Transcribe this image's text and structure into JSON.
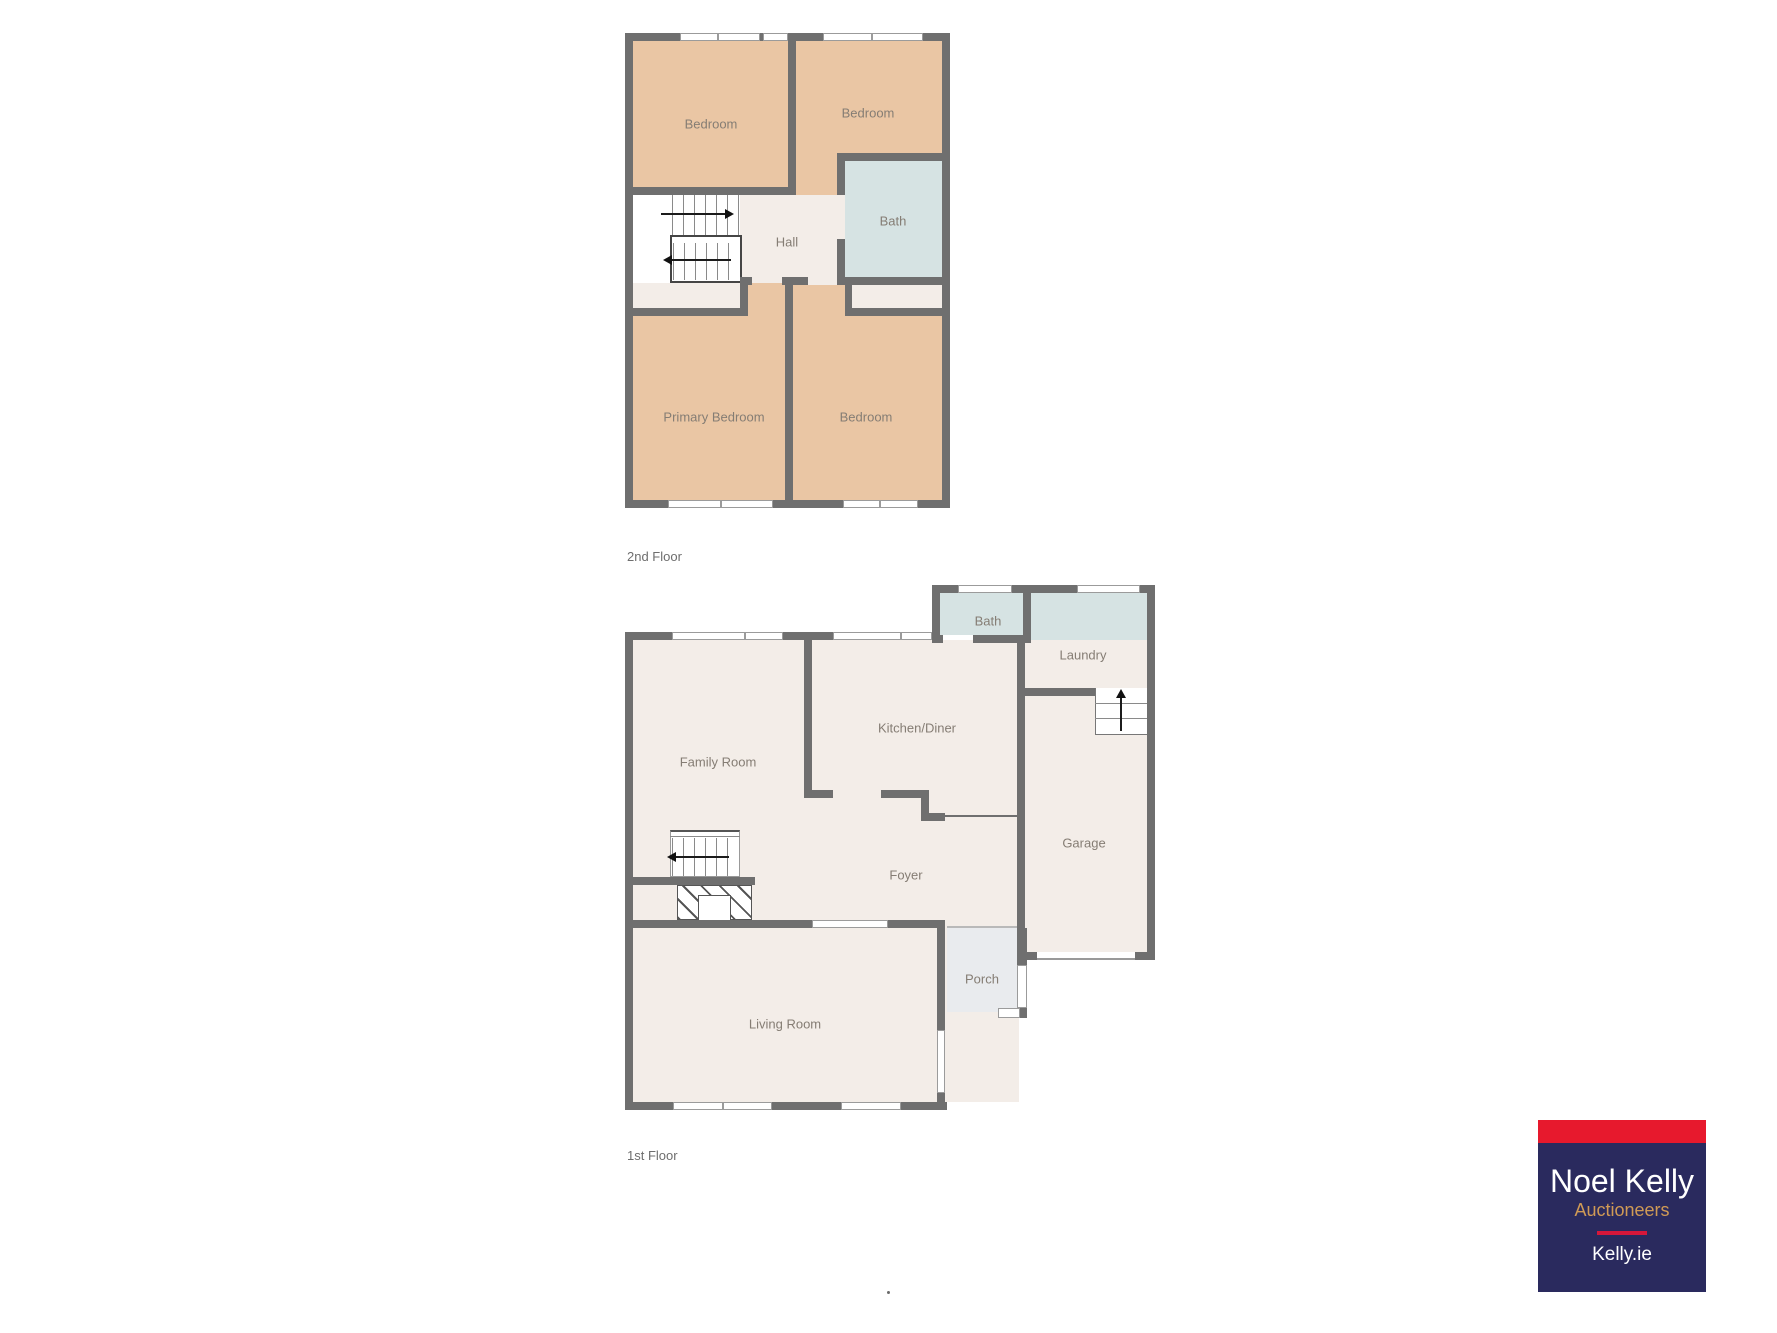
{
  "floors": [
    {
      "caption": "2nd Floor",
      "rooms": [
        {
          "name": "bedroom-top-left",
          "label": "Bedroom"
        },
        {
          "name": "bedroom-top-right",
          "label": "Bedroom"
        },
        {
          "name": "bath",
          "label": "Bath"
        },
        {
          "name": "hall",
          "label": "Hall"
        },
        {
          "name": "primary-bedroom",
          "label": "Primary Bedroom"
        },
        {
          "name": "bedroom-bottom",
          "label": "Bedroom"
        }
      ]
    },
    {
      "caption": "1st Floor",
      "rooms": [
        {
          "name": "bath",
          "label": "Bath"
        },
        {
          "name": "laundry",
          "label": "Laundry"
        },
        {
          "name": "kitchen-diner",
          "label": "Kitchen/Diner"
        },
        {
          "name": "family-room",
          "label": "Family Room"
        },
        {
          "name": "foyer",
          "label": "Foyer"
        },
        {
          "name": "garage",
          "label": "Garage"
        },
        {
          "name": "porch",
          "label": "Porch"
        },
        {
          "name": "living-room",
          "label": "Living Room"
        }
      ]
    }
  ],
  "logo": {
    "title": "Noel Kelly",
    "subtitle": "Auctioneers",
    "website": "Kelly.ie",
    "colors": {
      "band": "#e7192d",
      "background": "#2a2a5e",
      "title_text": "#ffffff",
      "subtitle_text": "#d09a55",
      "divider": "#d6173a"
    }
  },
  "colors": {
    "wall": "#6f6f6f",
    "bedroom_fill": "#eac6a4",
    "floor_fill": "#f3ede8",
    "wet_room_fill": "#d6e3e3",
    "porch_fill": "#e9ebee",
    "window": "#ffffff",
    "room_label_text": "#857d74",
    "caption_text": "#6e6e6e"
  },
  "stray_mark": "."
}
